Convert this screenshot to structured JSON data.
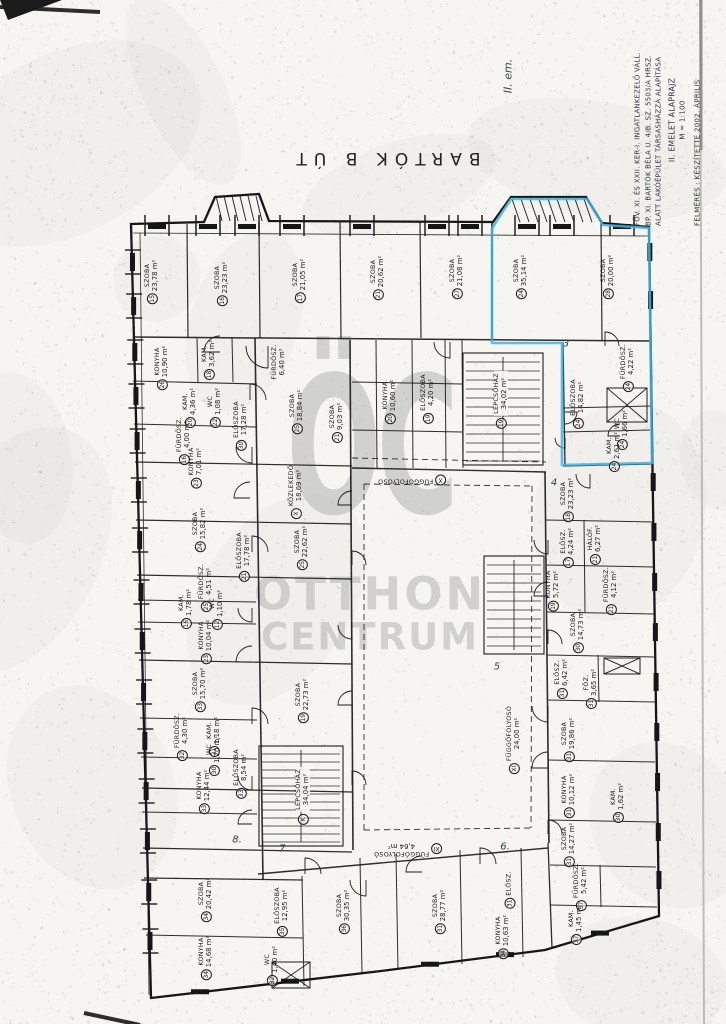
{
  "page": {
    "street_label": "BARTÓK  B  ÚT",
    "floor_note": "II. em."
  },
  "title_block": {
    "lines": [
      "FŐV. XI. ÉS XXII. KER-I. INGATLANKEZELŐ VÁLL.",
      "BP. XI. BARTÓK BÉLA U. 4/B. SZ. 5503/A HRSZ.",
      "ALATT LAKÓÉPÜLET TÁRSASHÁZZÁ ALAPÍTÁSA",
      "II. EMELET ALAPRAJZ",
      "M = 1:100",
      "FELMÉRÉS : KÉSZÍTETTE   2002. ÁPRILIS"
    ]
  },
  "watermark": {
    "logo": "ÖC",
    "line1": "OTTHON",
    "line2": "CENTRUM"
  },
  "highlight_color": "#3fb3e6",
  "area_unit": "m²",
  "rooms": [
    {
      "num": "15",
      "name": "SZOBA",
      "area": "23,78",
      "x": 152,
      "y": 282
    },
    {
      "num": "16",
      "name": "SZOBA",
      "area": "23,23",
      "x": 222,
      "y": 284
    },
    {
      "num": "17",
      "name": "SZOBA",
      "area": "21,05",
      "x": 300,
      "y": 281
    },
    {
      "num": "21",
      "name": "SZOBA",
      "area": "20,62",
      "x": 378,
      "y": 278
    },
    {
      "num": "27",
      "name": "SZOBA",
      "area": "21,08",
      "x": 457,
      "y": 277
    },
    {
      "num": "24",
      "name": "SZOBA",
      "area": "35,14",
      "x": 521,
      "y": 277
    },
    {
      "num": "28",
      "name": "SZOBA",
      "area": "20,00",
      "x": 608,
      "y": 277
    },
    {
      "num": "18",
      "name": "KAM.",
      "area": "3,62",
      "x": 209,
      "y": 360
    },
    {
      "num": "",
      "name": "FÜRDŐSZ.",
      "area": "6,40",
      "x": 279,
      "y": 362
    },
    {
      "num": "26",
      "name": "KONYHA",
      "area": "10,90",
      "x": 162,
      "y": 368
    },
    {
      "num": "20",
      "name": "KAM.",
      "area": "4,36",
      "x": 190,
      "y": 408
    },
    {
      "num": "22",
      "name": "WC",
      "area": "1,08",
      "x": 215,
      "y": 408
    },
    {
      "num": "16",
      "name": "FÜRDŐSZ.",
      "area": "4,00",
      "x": 184,
      "y": 441
    },
    {
      "num": "25",
      "name": "SZOBA",
      "area": "18,84",
      "x": 297,
      "y": 412
    },
    {
      "num": "21",
      "name": "SZOBA",
      "area": "9,03",
      "x": 337,
      "y": 423
    },
    {
      "num": "20",
      "name": "KONYHA",
      "area": "10,60",
      "x": 390,
      "y": 402
    },
    {
      "num": "19",
      "name": "ELŐSZOBA",
      "area": "4,20",
      "x": 428,
      "y": 399
    },
    {
      "num": "24",
      "name": "ELŐSZOBA",
      "area": "14,82",
      "x": 578,
      "y": 404
    },
    {
      "num": "24",
      "name": "FÜRDŐSZ.",
      "area": "4,22",
      "x": 628,
      "y": 368
    },
    {
      "num": "24",
      "name": "WC",
      "area": "1,66",
      "x": 622,
      "y": 430
    },
    {
      "num": "24",
      "name": "KAM.",
      "area": "2,61",
      "x": 614,
      "y": 452
    },
    {
      "num": "19",
      "name": "LÉPCSŐHÁZ",
      "area": "34,02",
      "x": 501,
      "y": 400
    },
    {
      "num": "X",
      "name": "KÖZLEKEDŐ",
      "area": "18,69",
      "x": 296,
      "y": 492
    },
    {
      "num": "30",
      "name": "ELŐSZOBA",
      "area": "17,28",
      "x": 241,
      "y": 426
    },
    {
      "num": "23",
      "name": "KONYHA",
      "area": "7,01",
      "x": 196,
      "y": 468
    },
    {
      "num": "24",
      "name": "SZOBA",
      "area": "15,82",
      "x": 200,
      "y": 530
    },
    {
      "num": "21",
      "name": "ELŐSZOBA",
      "area": "17,78",
      "x": 244,
      "y": 557
    },
    {
      "num": "25",
      "name": "SZOBA",
      "area": "22,62",
      "x": 302,
      "y": 548
    },
    {
      "num": "25",
      "name": "FÜRDŐSZ.",
      "area": "4,51",
      "x": 206,
      "y": 588
    },
    {
      "num": "16",
      "name": "KAM.",
      "area": "1,78",
      "x": 186,
      "y": 609
    },
    {
      "num": "12",
      "name": "WC",
      "area": "1,10",
      "x": 217,
      "y": 610
    },
    {
      "num": "23",
      "name": "KONYHA",
      "area": "10,04",
      "x": 206,
      "y": 642
    },
    {
      "num": "19",
      "name": "SZOBA",
      "area": "22,73",
      "x": 303,
      "y": 701
    },
    {
      "num": "33",
      "name": "SZOBA",
      "area": "15,70",
      "x": 200,
      "y": 690
    },
    {
      "num": "32",
      "name": "FÜRDŐSZ.",
      "area": "4,30",
      "x": 182,
      "y": 737
    },
    {
      "num": "31",
      "name": "KAM.",
      "area": "1,18",
      "x": 214,
      "y": 737
    },
    {
      "num": "30",
      "name": "WC",
      "area": "1,20",
      "x": 214,
      "y": 756
    },
    {
      "num": "33",
      "name": "ELŐSZOBA",
      "area": "8,54",
      "x": 241,
      "y": 774
    },
    {
      "num": "33",
      "name": "KONYHA",
      "area": "12,44",
      "x": 204,
      "y": 792
    },
    {
      "num": "K",
      "name": "LÉPCSŐHÁZ",
      "area": "34,04",
      "x": 303,
      "y": 796
    },
    {
      "num": "34",
      "name": "SZOBA",
      "area": "20,42",
      "x": 206,
      "y": 900
    },
    {
      "num": "34",
      "name": "KONYHA",
      "area": "14,68",
      "x": 206,
      "y": 958
    },
    {
      "num": "32",
      "name": "WC",
      "area": "1,40",
      "x": 272,
      "y": 966
    },
    {
      "num": "35",
      "name": "ELŐSZOBA",
      "area": "12,95",
      "x": 282,
      "y": 912
    },
    {
      "num": "36",
      "name": "SZOBA",
      "area": "30,35",
      "x": 344,
      "y": 912
    },
    {
      "num": "31",
      "name": "SZOBA",
      "area": "28,77",
      "x": 440,
      "y": 912
    },
    {
      "num": "31",
      "name": "ELŐSZ.",
      "area": "",
      "x": 510,
      "y": 890
    },
    {
      "num": "34",
      "name": "KONYHA",
      "area": "10,63",
      "x": 503,
      "y": 937
    },
    {
      "num": "37",
      "name": "FÜRDŐSZ.",
      "area": "5,42",
      "x": 581,
      "y": 887
    },
    {
      "num": "37",
      "name": "KAM.",
      "area": "1,45",
      "x": 576,
      "y": 925
    },
    {
      "num": "XI",
      "name": "FÜGGŐFOLYOSÓ",
      "area": "24,00",
      "x": 514,
      "y": 740
    },
    {
      "num": "31",
      "name": "ELŐSZ.",
      "area": "6,42",
      "x": 562,
      "y": 679
    },
    {
      "num": "31",
      "name": "FŐZ.",
      "area": "3,65",
      "x": 591,
      "y": 689
    },
    {
      "num": "31",
      "name": "SZOBA",
      "area": "19,86",
      "x": 569,
      "y": 740
    },
    {
      "num": "31",
      "name": "KONYHA",
      "area": "10,12",
      "x": 569,
      "y": 796
    },
    {
      "num": "30",
      "name": "KAM.",
      "area": "1,62",
      "x": 618,
      "y": 803
    },
    {
      "num": "31",
      "name": "SZOBA",
      "area": "14,27",
      "x": 569,
      "y": 845
    },
    {
      "num": "17",
      "name": "ELŐSZ.",
      "area": "4,24",
      "x": 568,
      "y": 548
    },
    {
      "num": "21",
      "name": "HÁLÓF.",
      "area": "6,27",
      "x": 595,
      "y": 545
    },
    {
      "num": "19",
      "name": "KONYHA",
      "area": "5,72",
      "x": 553,
      "y": 591
    },
    {
      "num": "21",
      "name": "FÜRDŐSZ.",
      "area": "4,12",
      "x": 611,
      "y": 591
    },
    {
      "num": "30",
      "name": "SZOBA",
      "area": "14,73",
      "x": 578,
      "y": 631
    },
    {
      "num": "18",
      "name": "SZOBA",
      "area": "23,23",
      "x": 568,
      "y": 500
    },
    {
      "num": "X",
      "name": "FÜGGŐFOLYOSÓ",
      "area": "",
      "x": 412,
      "y": 480,
      "rot": 180
    },
    {
      "num": "XI",
      "name": "FÜGGŐFOLYOSÓ",
      "area": "4,64",
      "x": 408,
      "y": 849,
      "rot": 180
    }
  ],
  "handwritten_marks": [
    {
      "text": "3",
      "x": 566,
      "y": 344
    },
    {
      "text": "4",
      "x": 554,
      "y": 483
    },
    {
      "text": "5",
      "x": 497,
      "y": 667
    },
    {
      "text": "6.",
      "x": 505,
      "y": 847
    },
    {
      "text": "7.",
      "x": 284,
      "y": 849
    },
    {
      "text": "8.",
      "x": 237,
      "y": 840
    }
  ]
}
